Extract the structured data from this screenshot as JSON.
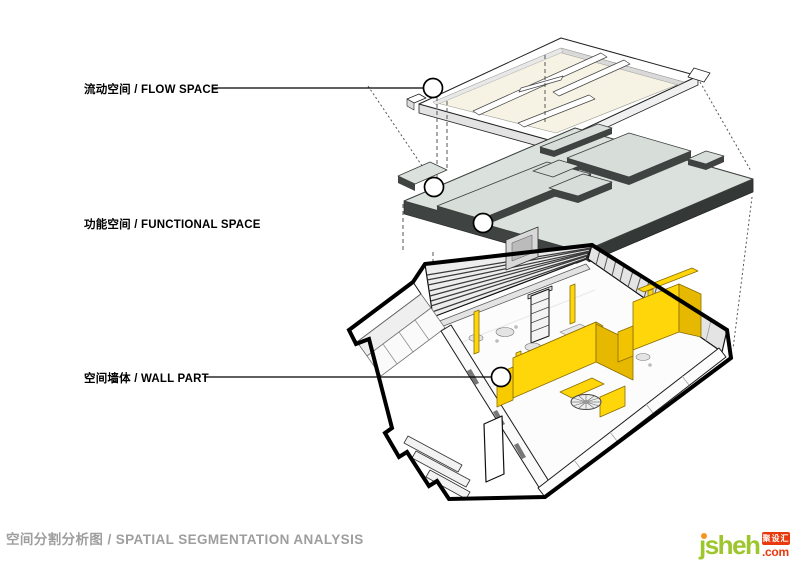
{
  "annotations": {
    "layers": [
      {
        "id": "flow-space",
        "label": "流动空间 / FLOW SPACE"
      },
      {
        "id": "functional-space",
        "label": "功能空间 / FUNCTIONAL SPACE"
      },
      {
        "id": "wall-part",
        "label": "空间墙体 / WALL PART"
      }
    ],
    "caption": "空间分割分析图 / SPATIAL SEGMENTATION ANALYSIS"
  },
  "logo": {
    "name": "jsheh",
    "badge": "聚设汇",
    "tld": ".com"
  },
  "colors": {
    "highlight_yellow": "#FFD60A",
    "yellow_shade": "#E6B800",
    "slab_top": "#DBE1DD",
    "slab_edge": "#3F4443",
    "plate_floor": "#F6F3E4",
    "outline_black": "#000000",
    "caption_gray": "#9E9E9E",
    "logo_green": "#9DC62D",
    "logo_red": "#E8380D",
    "logo_orange": "#F7941D"
  }
}
